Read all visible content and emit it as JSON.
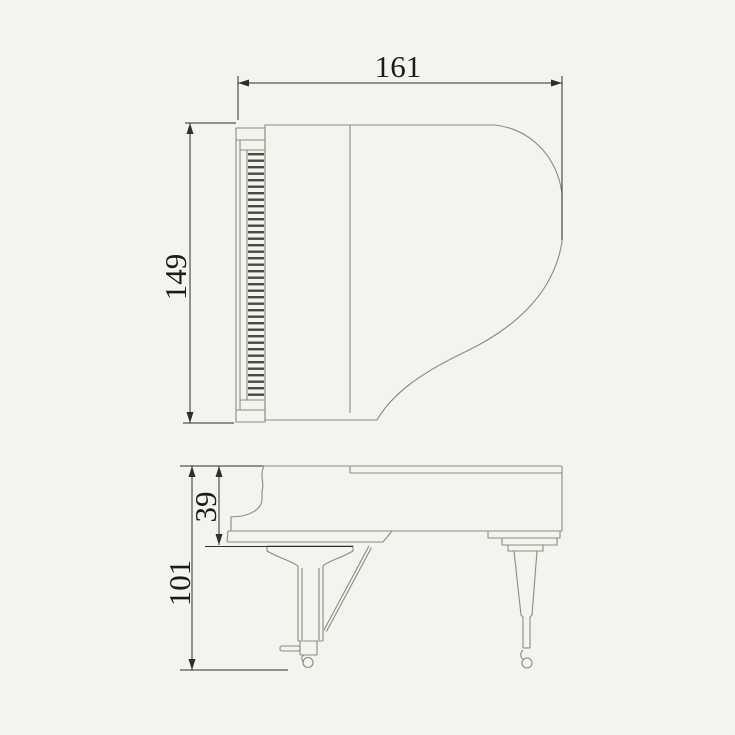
{
  "drawing": {
    "background_color": "#f4f3ed",
    "outline_color": "#8b8b83",
    "dimension_line_color": "#2e2e2a",
    "text_color": "#1b1b18",
    "keyboard_stripe_color": "#4a4a45",
    "top_view": {
      "length_label": "161",
      "width_label": "149"
    },
    "side_view": {
      "case_height_label": "39",
      "overall_height_label": "101"
    }
  }
}
